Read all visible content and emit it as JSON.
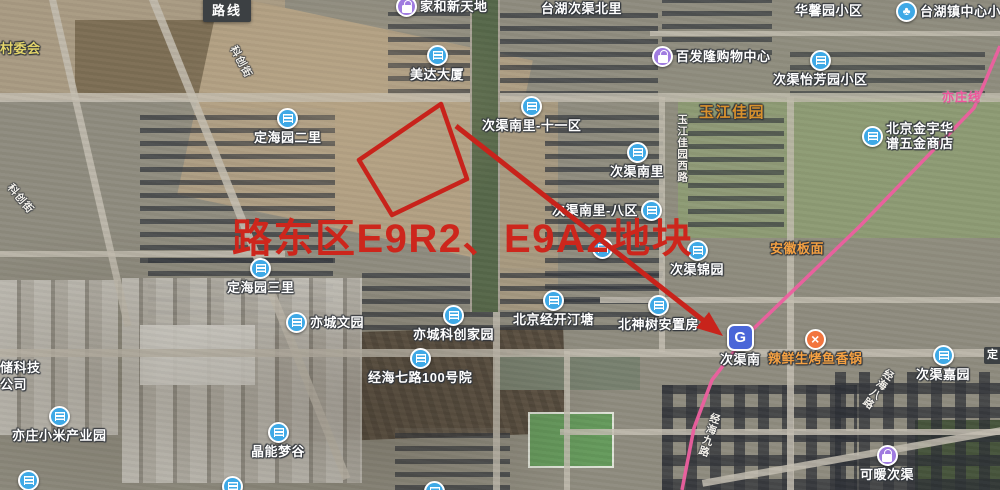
{
  "app": {
    "route_tooltip": "路线",
    "partial_label_right": "定"
  },
  "annotation": {
    "text": "路东区E9R2、E9A2地块"
  },
  "subway": {
    "line_label": "亦庄线",
    "station": "次渠南"
  },
  "pois": [
    {
      "label": "家和新天地"
    },
    {
      "label": "台湖次渠北里"
    },
    {
      "label": "华馨园小区"
    },
    {
      "label": "台湖镇中心小"
    },
    {
      "label": "美达大厦"
    },
    {
      "label": "百发隆购物中心"
    },
    {
      "label": "次渠怡芳园小区"
    },
    {
      "label": "次渠南里-十一区"
    },
    {
      "label": "北京金宇华谱五金商店"
    },
    {
      "label": "次渠南里"
    },
    {
      "label": "次渠南里-八区"
    },
    {
      "label": "次渠锦园"
    },
    {
      "label": "玉江佳园"
    },
    {
      "label": "安徽板面"
    },
    {
      "label": "定海园二里"
    },
    {
      "label": "定海园三里"
    },
    {
      "label": "亦城文园"
    },
    {
      "label": "亦城科创家园"
    },
    {
      "label": "北京经开汀塘"
    },
    {
      "label": "北神树安置房"
    },
    {
      "label": "经海七路100号院"
    },
    {
      "label": "辣鲜生烤鱼香锅"
    },
    {
      "label": "次渠嘉园"
    },
    {
      "label": "亦庄小米产业园"
    },
    {
      "label": "晶能梦谷"
    },
    {
      "label": "可暖次渠"
    },
    {
      "label": "村委会"
    },
    {
      "label": "储科技",
      "label2": "公司"
    }
  ],
  "roads": [
    {
      "label": "科创街"
    },
    {
      "label": "科创街"
    },
    {
      "label": "玉江佳园西路"
    },
    {
      "label": "经海九路"
    },
    {
      "label": "经海八路"
    }
  ],
  "icons": {
    "building-icon": "blue circle with white building",
    "shopping-bag-icon": "purple circle with white bag",
    "school-tree-icon": "blue circle with white tree",
    "food-icon": "orange circle with white cross",
    "metro-icon": "blue rounded square with white G"
  },
  "colors": {
    "annotation_red": "#cd261c",
    "subway_line_pink": "#ed5f9f",
    "poi_blue": "#3fa9e6",
    "poi_purple": "#a07ce0",
    "poi_orange": "#f2753e",
    "metro_blue": "#4a66d8",
    "area_label_orange": "#d9912c",
    "village_label_yellow": "#e3d46a"
  }
}
